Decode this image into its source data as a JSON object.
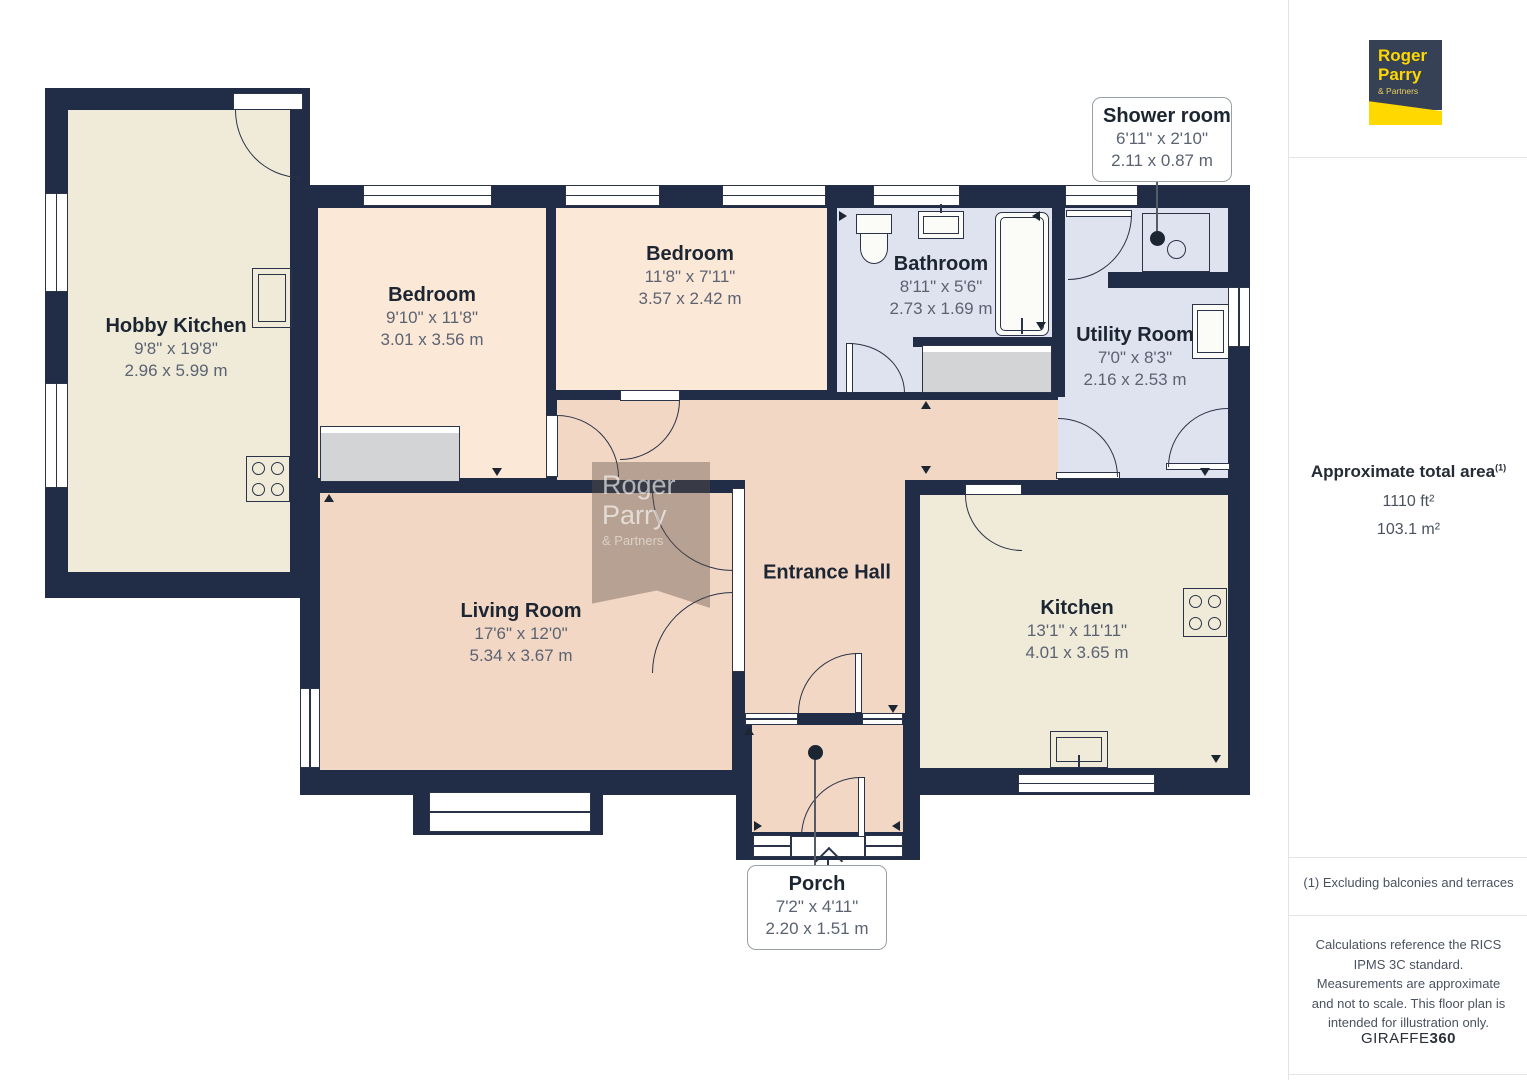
{
  "floorplan": {
    "rooms": {
      "hobby_kitchen": {
        "name": "Hobby Kitchen",
        "imperial": "9'8\" x 19'8\"",
        "metric": "2.96 x 5.99 m"
      },
      "bedroom_1": {
        "name": "Bedroom",
        "imperial": "9'10\" x 11'8\"",
        "metric": "3.01 x 3.56 m"
      },
      "bedroom_2": {
        "name": "Bedroom",
        "imperial": "11'8\" x 7'11\"",
        "metric": "3.57 x 2.42 m"
      },
      "bathroom": {
        "name": "Bathroom",
        "imperial": "8'11\" x 5'6\"",
        "metric": "2.73 x 1.69 m"
      },
      "utility_room": {
        "name": "Utility Room",
        "imperial": "7'0\" x 8'3\"",
        "metric": "2.16 x 2.53 m"
      },
      "entrance_hall": {
        "name": "Entrance Hall"
      },
      "living_room": {
        "name": "Living Room",
        "imperial": "17'6\" x 12'0\"",
        "metric": "5.34 x 3.67 m"
      },
      "kitchen": {
        "name": "Kitchen",
        "imperial": "13'1\" x 11'11\"",
        "metric": "4.01 x 3.65 m"
      },
      "shower_room": {
        "name": "Shower room",
        "imperial": "6'11\" x 2'10\"",
        "metric": "2.11 x 0.87 m"
      },
      "porch": {
        "name": "Porch",
        "imperial": "7'2\" x 4'11\"",
        "metric": "2.20 x 1.51 m"
      }
    },
    "watermark": {
      "line1": "Roger",
      "line2": "Parry",
      "line3": "& Partners"
    }
  },
  "sidebar": {
    "logo": {
      "line1": "Roger",
      "line2": "Parry",
      "line3": "& Partners"
    },
    "area": {
      "title": "Approximate total area",
      "superscript": "(1)",
      "imperial": "1110 ft²",
      "metric": "103.1 m²"
    },
    "footnote": "(1) Excluding balconies and terraces",
    "disclaimer": "Calculations reference the RICS IPMS 3C standard. Measurements are approximate and not to scale. This floor plan is intended for illustration only.",
    "brand": {
      "name": "GIRAFFE",
      "suffix": "360"
    }
  },
  "palette": {
    "wall": "#212d47",
    "floor_cream": "#f0ebd9",
    "floor_peach": "#fce8d6",
    "floor_pink": "#f3d7c5",
    "floor_blue": "#dfe3ef",
    "fixture_gray": "#d2d4d5",
    "label_dark": "#1c2532",
    "label_gray": "#5b6372",
    "logo_navy": "#364156",
    "logo_yellow": "#ffd800"
  }
}
